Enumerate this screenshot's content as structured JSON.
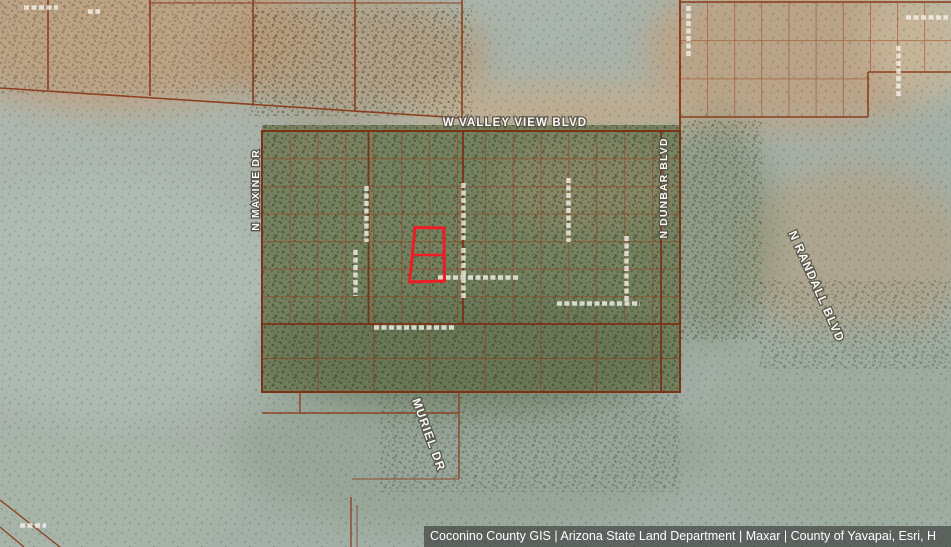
{
  "map": {
    "street_labels": {
      "valley_view_blvd": "W VALLEY VIEW BLVD",
      "maxine_dr": "N MAXINE DR",
      "dunbar_blvd": "N DUNBAR BLVD",
      "randall_blvd": "N RANDALL BLVD",
      "muriel_dr": "MURIEL DR"
    },
    "selected_parcel": {
      "highlight_color": "#ee1c25"
    },
    "colors": {
      "parcel_line": "#8a3a1a",
      "street_label_text": "#fdfdf8",
      "attribution_bg": "rgba(25,25,25,0.50)"
    },
    "attribution": "Coconino County GIS | Arizona State Land Department | Maxar | County of Yavapai, Esri, H"
  }
}
